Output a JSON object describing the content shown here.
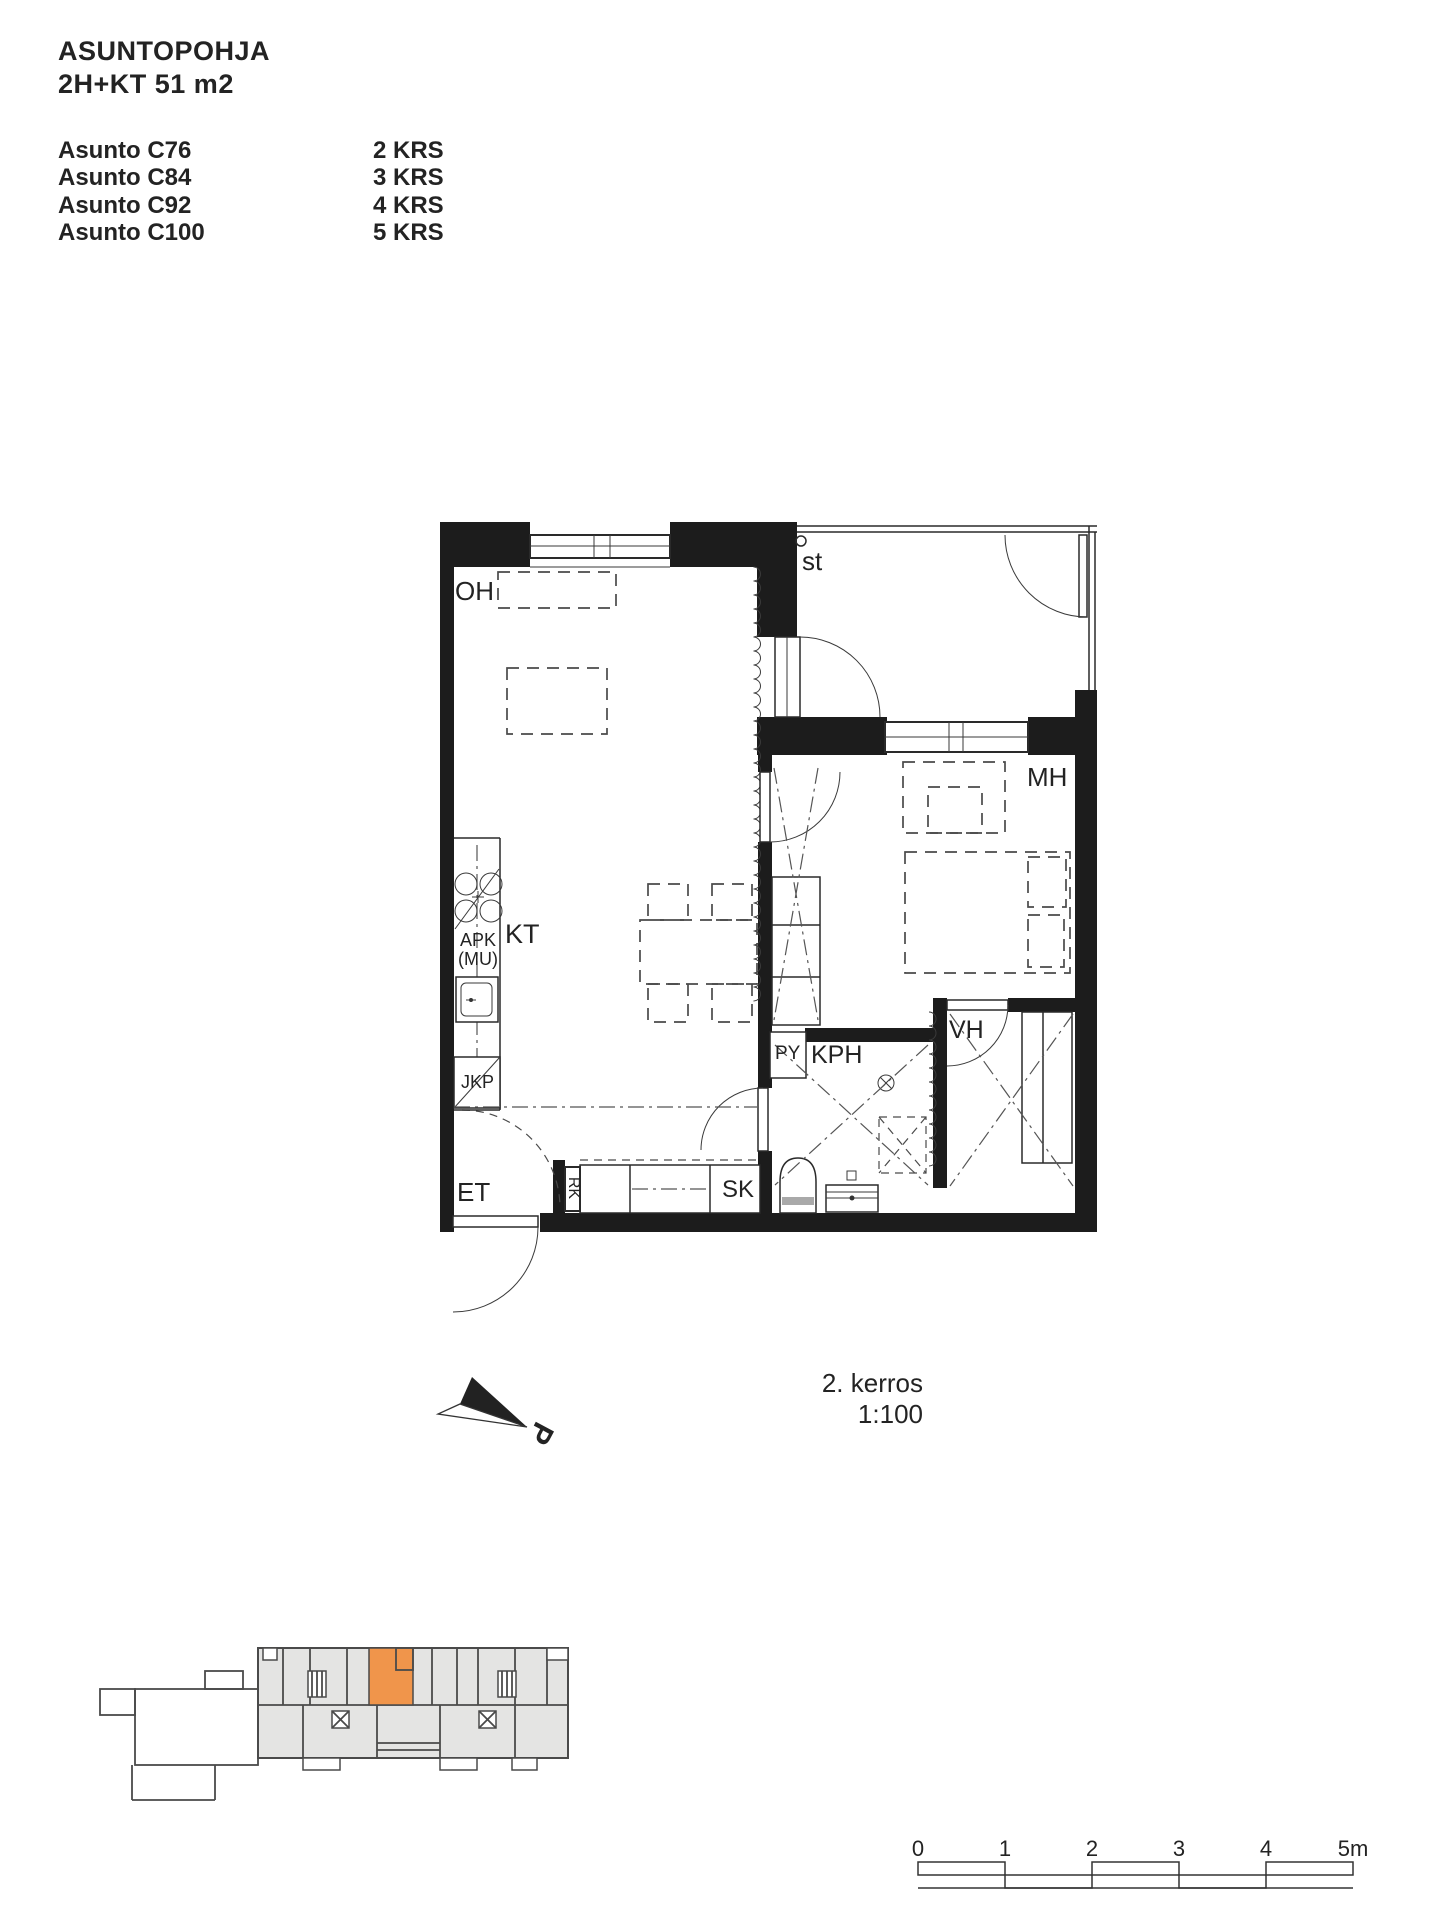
{
  "header": {
    "title": "ASUNTOPOHJA",
    "subtitle": "2H+KT 51 m2",
    "units": [
      {
        "name": "Asunto C76",
        "floor": "2 KRS"
      },
      {
        "name": "Asunto C84",
        "floor": "3 KRS"
      },
      {
        "name": "Asunto C92",
        "floor": "4 KRS"
      },
      {
        "name": "Asunto C100",
        "floor": "5 KRS"
      }
    ]
  },
  "plan": {
    "labels": {
      "oh": "OH",
      "kt": "KT",
      "mh": "MH",
      "kph": "KPH",
      "py": "PY",
      "vh": "VH",
      "et": "ET",
      "sk": "SK",
      "rk": "RK",
      "st": "st",
      "apk_line1": "APK",
      "apk_line2": "(MU)",
      "jkp": "JKP"
    }
  },
  "annotation": {
    "floor_label": "2. kerros",
    "scale_label": "1:100",
    "north_label": "P"
  },
  "scalebar": {
    "ticks": [
      "0",
      "1",
      "2",
      "3",
      "4",
      "5m"
    ]
  },
  "colors": {
    "highlight": "#F0954B",
    "building_fill": "#E4E4E3",
    "line": "#4A4A4A"
  }
}
